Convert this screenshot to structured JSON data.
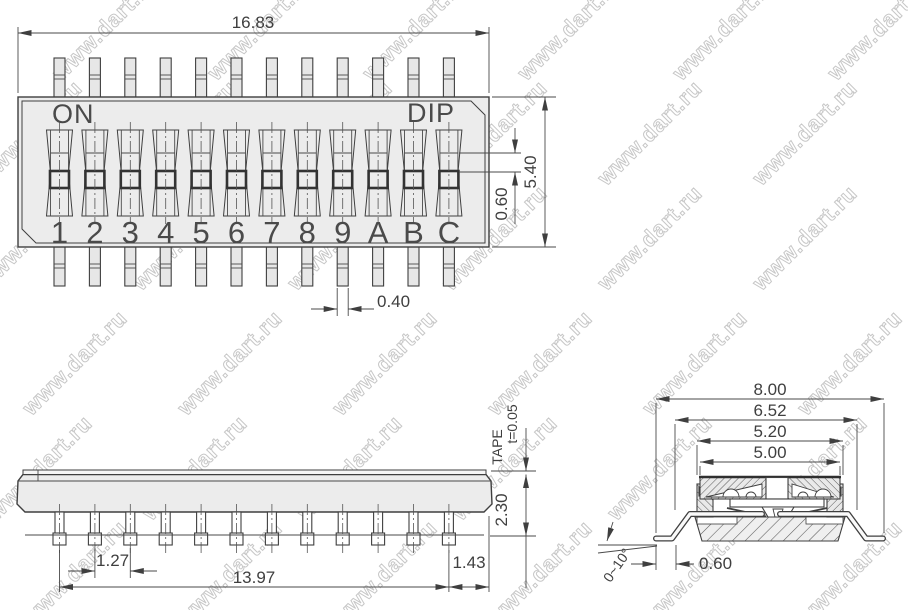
{
  "watermark": {
    "text": "www.dart.ru"
  },
  "top_view": {
    "on_label": "ON",
    "dip_label": "DIP",
    "switch_labels": [
      "1",
      "2",
      "3",
      "4",
      "5",
      "6",
      "7",
      "8",
      "9",
      "A",
      "B",
      "C"
    ],
    "dim_overall_width": "16.83",
    "dim_overall_height": "5.40",
    "dim_actuator_travel": "0.60",
    "dim_pin_width": "0.40"
  },
  "side_view": {
    "tape_label": "TAPE",
    "dim_tape_thickness": "t=0.05",
    "dim_body_height": "2.30",
    "dim_pin_pitch": "1.27",
    "dim_pin_span": "13.97",
    "dim_end_offset": "1.43"
  },
  "section_view": {
    "dim_overall_width": "8.00",
    "dim_lead_span": "6.52",
    "dim_body_width": "5.20",
    "dim_cap_width": "5.00",
    "dim_foot_length": "0.60",
    "dim_foot_angle": "0~10°"
  }
}
